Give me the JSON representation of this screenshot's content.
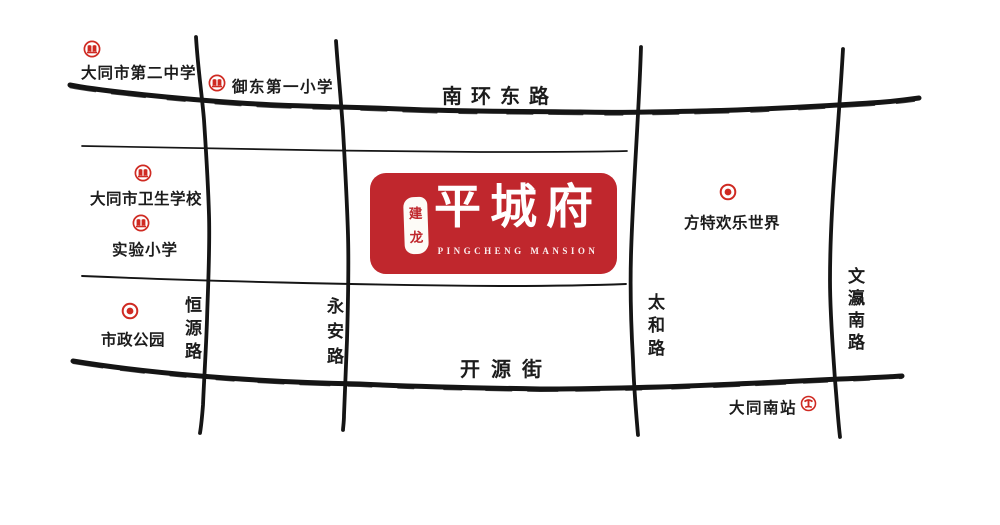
{
  "logo": {
    "seal_top": "建",
    "seal_bottom": "龙",
    "name": "平城府",
    "subtitle": "PINGCHENG MANSION"
  },
  "roads": {
    "nanhuan_east": "南环东路",
    "kaiyuan_street": "开源街",
    "hengyuan": "恒源路",
    "yongan": "永安路",
    "taihe": "太和路",
    "wenying_south": "文瀛南路"
  },
  "landmarks": {
    "datong_no2_middle_school": {
      "label": "大同市第二中学",
      "icon": "school-icon"
    },
    "yudong_first_primary": {
      "label": "御东第一小学",
      "icon": "school-icon"
    },
    "datong_health_school": {
      "label": "大同市卫生学校",
      "icon": "school-icon"
    },
    "experimental_primary": {
      "label": "实验小学",
      "icon": "school-icon"
    },
    "municipal_park": {
      "label": "市政公园",
      "icon": "park-icon"
    },
    "fantawild_adventure": {
      "label": "方特欢乐世界",
      "icon": "attraction-icon"
    },
    "datong_south_station": {
      "label": "大同南站",
      "icon": "railway-icon"
    }
  },
  "colors": {
    "brand_red": "#c0272d",
    "icon_red": "#cf2a22",
    "ink": "#151515",
    "background": "#ffffff"
  }
}
